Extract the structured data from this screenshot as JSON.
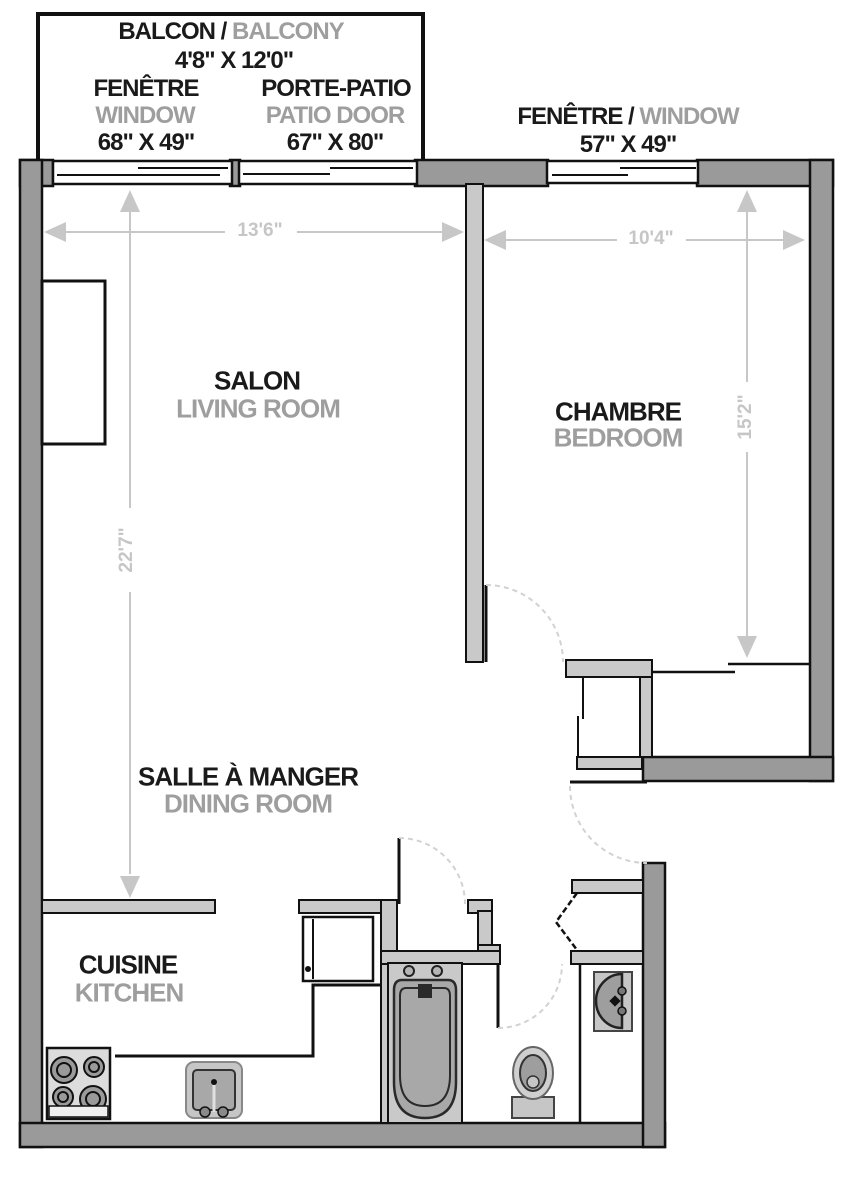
{
  "balcony": {
    "fr": "BALCON",
    "sep": " / ",
    "en": "BALCONY",
    "size": "4'8\" X 12'0\""
  },
  "window_living": {
    "fr": "FENÊTRE",
    "en": "WINDOW",
    "size": "68\" X 49\""
  },
  "patio_door": {
    "fr": "PORTE-PATIO",
    "en": "PATIO DOOR",
    "size": "67\" X 80\""
  },
  "window_bedroom": {
    "fr": "FENÊTRE",
    "sep": " / ",
    "en": "WINDOW",
    "size": "57\" X 49\""
  },
  "rooms": {
    "living": {
      "fr": "SALON",
      "en": "LIVING ROOM"
    },
    "bedroom": {
      "fr": "CHAMBRE",
      "en": "BEDROOM"
    },
    "dining": {
      "fr": "SALLE À MANGER",
      "en": "DINING ROOM"
    },
    "kitchen": {
      "fr": "CUISINE",
      "en": "KITCHEN"
    }
  },
  "dimensions": {
    "living_width": "13'6\"",
    "bedroom_width": "10'4\"",
    "living_length": "22'7\"",
    "bedroom_length": "15'2\""
  },
  "colors": {
    "wall_dark": "#9a9a9a",
    "wall_light": "#c9c9c9",
    "outline": "#111111",
    "dimension_gray": "#c7c7c7",
    "label_primary": "#1a1a1a",
    "label_secondary": "#9e9e9e",
    "fixture_gray": "#a8a8a8"
  }
}
